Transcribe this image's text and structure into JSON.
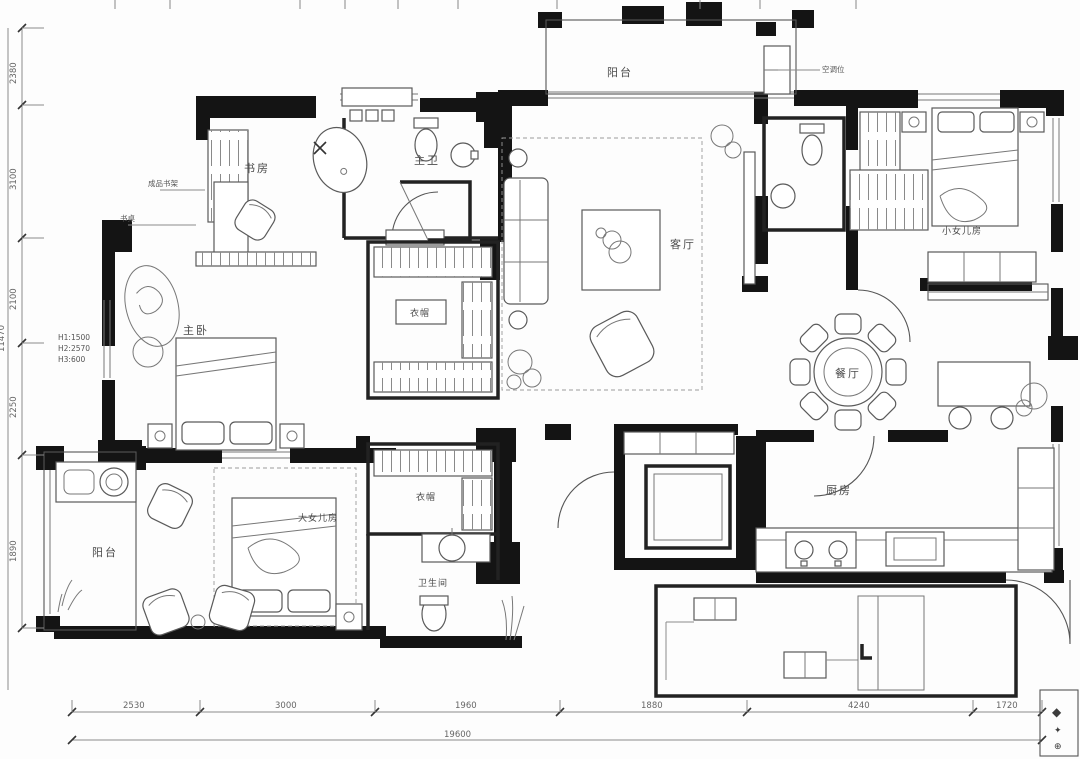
{
  "drawing": {
    "rooms": {
      "study": "书房",
      "master_bath": "主卫",
      "master_bedroom": "主卧",
      "closet_upper": "衣帽",
      "closet_lower": "衣帽",
      "bathroom": "卫生间",
      "living": "客厅",
      "balcony_top": "阳台",
      "daughter_small": "小女儿房",
      "dining": "餐厅",
      "kitchen": "厨房",
      "daughter_big": "大女儿房",
      "balcony_side": "阳台"
    },
    "annotations": {
      "bookshelf": "成品书架",
      "desk": "书桌",
      "ac_unit": "空调位",
      "heights": [
        "H1:1500",
        "H2:2570",
        "H3:600"
      ]
    },
    "dimensions": {
      "bottom": [
        "2530",
        "3000",
        "1960",
        "1880",
        "4240",
        "1720"
      ],
      "bottom_total": "19600",
      "left": [
        "2380",
        "3100",
        "2100",
        "2250",
        "1890"
      ],
      "left_total": "11470"
    },
    "legend": {
      "symbols": [
        "◆",
        "✦",
        "⊕"
      ]
    },
    "colors": {
      "wall": "#141414",
      "line": "#555555",
      "dim": "#777777"
    }
  }
}
